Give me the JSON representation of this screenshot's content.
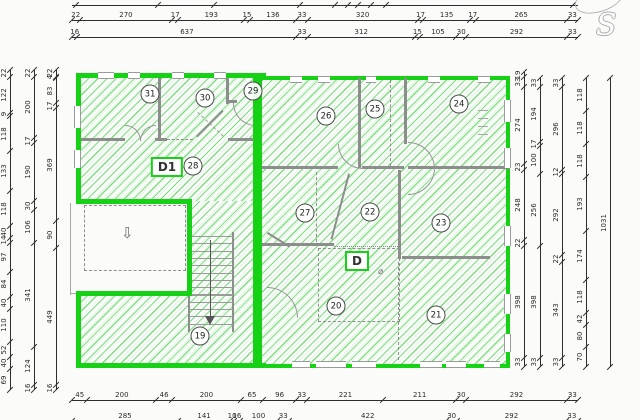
{
  "logo": {
    "letter": "S"
  },
  "units": {
    "d1": {
      "label": "D1"
    },
    "d": {
      "label": "D"
    }
  },
  "rooms": [
    {
      "number": "19",
      "x": 200,
      "y": 336
    },
    {
      "number": "20",
      "x": 336,
      "y": 306
    },
    {
      "number": "21",
      "x": 436,
      "y": 315
    },
    {
      "number": "22",
      "x": 370,
      "y": 212
    },
    {
      "number": "23",
      "x": 441,
      "y": 223
    },
    {
      "number": "24",
      "x": 459,
      "y": 104
    },
    {
      "number": "25",
      "x": 375,
      "y": 109
    },
    {
      "number": "26",
      "x": 326,
      "y": 116
    },
    {
      "number": "27",
      "x": 305,
      "y": 213
    },
    {
      "number": "28",
      "x": 193,
      "y": 166
    },
    {
      "number": "29",
      "x": 253,
      "y": 91
    },
    {
      "number": "30",
      "x": 205,
      "y": 98
    },
    {
      "number": "31",
      "x": 150,
      "y": 94
    }
  ],
  "symbols": {
    "porch_arrow": "⇩",
    "door_symbol": "⌀"
  },
  "colors": {
    "unit_outline": "#17d117",
    "hatch_line": "#2cc62c",
    "wall": "#8d8d8d",
    "dimension": "#2e2e2e"
  },
  "dimensions": {
    "top": [
      {
        "id": "top-row-0",
        "orient": "h",
        "y": 5,
        "x1": 72,
        "x2": 578,
        "values": [],
        "ticks": [
          0.008,
          0.17,
          0.28,
          0.45,
          0.52,
          0.545,
          0.565,
          0.59,
          0.62,
          0.99
        ],
        "cut_off": true
      },
      {
        "id": "top-row-1",
        "orient": "h",
        "y": 20,
        "x1": 72,
        "x2": 578,
        "values": [
          22,
          270,
          17,
          193,
          15,
          136,
          33,
          320,
          17,
          135,
          17,
          265,
          33
        ]
      },
      {
        "id": "top-row-2",
        "orient": "h",
        "y": 37,
        "x1": 72,
        "x2": 578,
        "values": [
          16,
          637,
          33,
          312,
          15,
          105,
          30,
          292,
          33
        ]
      }
    ],
    "bottom": [
      {
        "id": "bottom-row-1",
        "orient": "h",
        "y": 400,
        "x1": 72,
        "x2": 578,
        "values": [
          45,
          200,
          46,
          200,
          65,
          96,
          33,
          221,
          211,
          30,
          292,
          33
        ]
      },
      {
        "id": "bottom-row-2",
        "orient": "h",
        "y": 421,
        "x1": 72,
        "x2": 578,
        "values": [
          285,
          141,
          10,
          16,
          100,
          33,
          422,
          30,
          292,
          33
        ],
        "cut_off": true
      }
    ],
    "left": [
      {
        "id": "left-col-1",
        "orient": "v",
        "x": 10,
        "y1": 70,
        "y2": 390,
        "values": [
          22,
          122,
          9,
          118,
          133,
          118,
          40,
          14,
          97,
          84,
          40,
          110,
          52,
          40,
          69
        ]
      },
      {
        "id": "left-col-2",
        "orient": "v",
        "x": 34,
        "y1": 70,
        "y2": 390,
        "values": [
          22,
          200,
          17,
          190,
          30,
          106,
          341,
          124,
          16
        ]
      },
      {
        "id": "left-col-3",
        "orient": "v",
        "x": 56,
        "y1": 70,
        "y2": 390,
        "values": [
          22,
          4,
          83,
          17,
          369,
          90,
          449,
          16
        ]
      }
    ],
    "right": [
      {
        "id": "right-col-1",
        "orient": "v",
        "x": 524,
        "y1": 72,
        "y2": 367,
        "values": [
          19,
          33,
          274,
          23,
          248,
          22,
          398,
          33
        ]
      },
      {
        "id": "right-col-2",
        "orient": "v",
        "x": 540,
        "y1": 78,
        "y2": 367,
        "values": [
          33,
          194,
          17,
          100,
          256,
          398,
          33
        ]
      },
      {
        "id": "right-col-3",
        "orient": "v",
        "x": 562,
        "y1": 78,
        "y2": 367,
        "values": [
          33,
          296,
          12,
          292,
          22,
          343,
          33
        ]
      },
      {
        "id": "right-col-4",
        "orient": "v",
        "x": 586,
        "y1": 78,
        "y2": 367,
        "values": [
          118,
          118,
          118,
          193,
          174,
          118,
          42,
          80,
          70
        ]
      },
      {
        "id": "right-col-5",
        "orient": "v",
        "x": 610,
        "y1": 78,
        "y2": 367,
        "values": [
          1031
        ]
      }
    ]
  }
}
